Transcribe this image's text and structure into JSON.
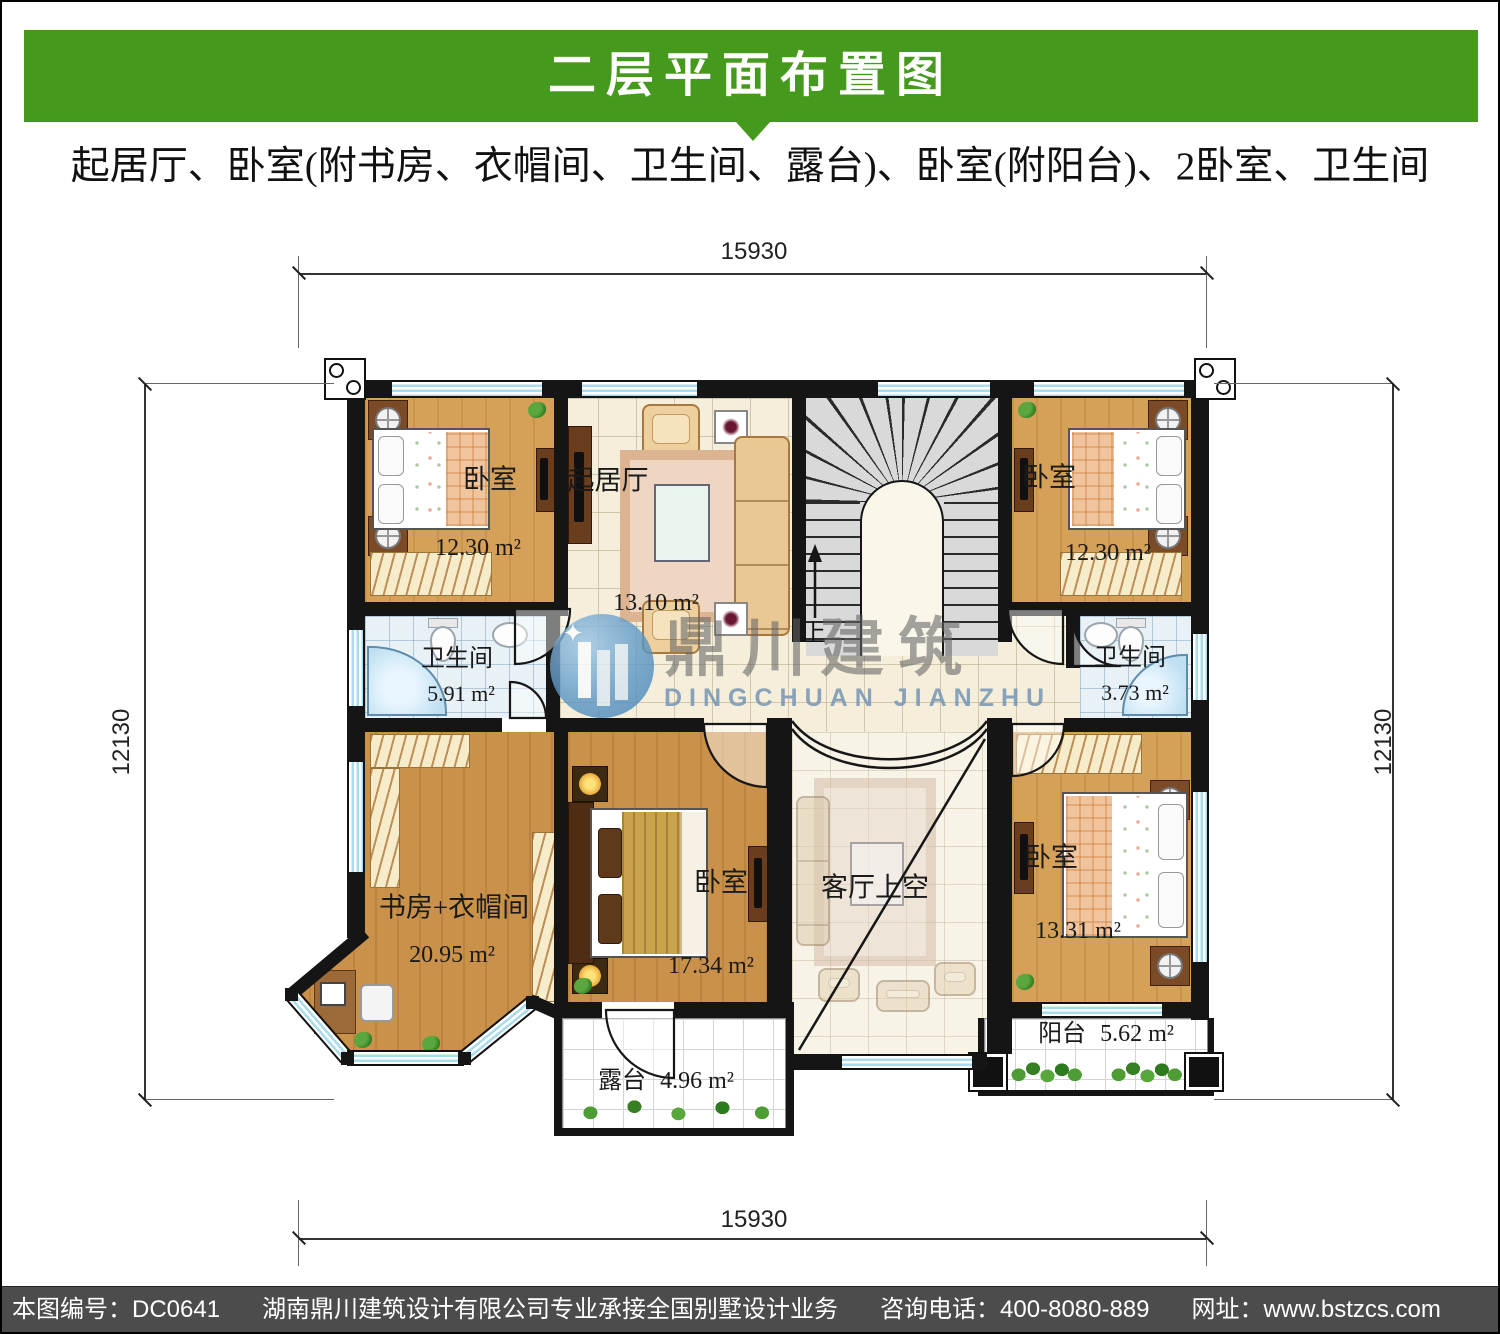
{
  "header": {
    "title": "二层平面布置图",
    "subtitle": "起居厅、卧室(附书房、衣帽间、卫生间、露台)、卧室(附阳台)、2卧室、卫生间"
  },
  "dimensions": {
    "top": "15930",
    "bottom": "15930",
    "left": "12130",
    "right": "12130"
  },
  "rooms": {
    "bedroom_tl": {
      "label": "卧室",
      "area": "12.30 m²"
    },
    "living": {
      "label": "起居厅",
      "area": "13.10 m²"
    },
    "bedroom_tr": {
      "label": "卧室",
      "area": "12.30 m²"
    },
    "bath_left": {
      "label": "卫生间",
      "area": "5.91 m²"
    },
    "bath_right": {
      "label": "卫生间",
      "area": "3.73 m²"
    },
    "study": {
      "label": "书房+衣帽间",
      "area": "20.95 m²"
    },
    "master_bedroom": {
      "label": "卧室",
      "area": "17.34 m²"
    },
    "living_void": {
      "label": "客厅上空"
    },
    "bedroom_br": {
      "label": "卧室",
      "area": "13.31 m²"
    },
    "balcony": {
      "label": "阳台",
      "area": "5.62 m²"
    },
    "terrace": {
      "label": "露台",
      "area": "4.96 m²"
    }
  },
  "stairs": {
    "up_label": "上"
  },
  "watermark": {
    "cn": "鼎川建筑",
    "en": "DINGCHUAN JIANZHU"
  },
  "footer": {
    "plan_no": "本图编号：DC0641",
    "company": "湖南鼎川建筑设计有限公司专业承接全国别墅设计业务",
    "phone": "咨询电话：400-8080-889",
    "website": "网址：www.bstzcs.com"
  },
  "colors": {
    "accent_green": "#45991c",
    "footer_bg": "#4c4c4c",
    "wall": "#151515",
    "wood": "#d5a057",
    "tile": "#f4eeda",
    "bath_tile": "#e8f1f6",
    "window_blue": "#a8dcec",
    "stair_gray": "#d9d9d9",
    "watermark_blue": "#74a3c8"
  }
}
